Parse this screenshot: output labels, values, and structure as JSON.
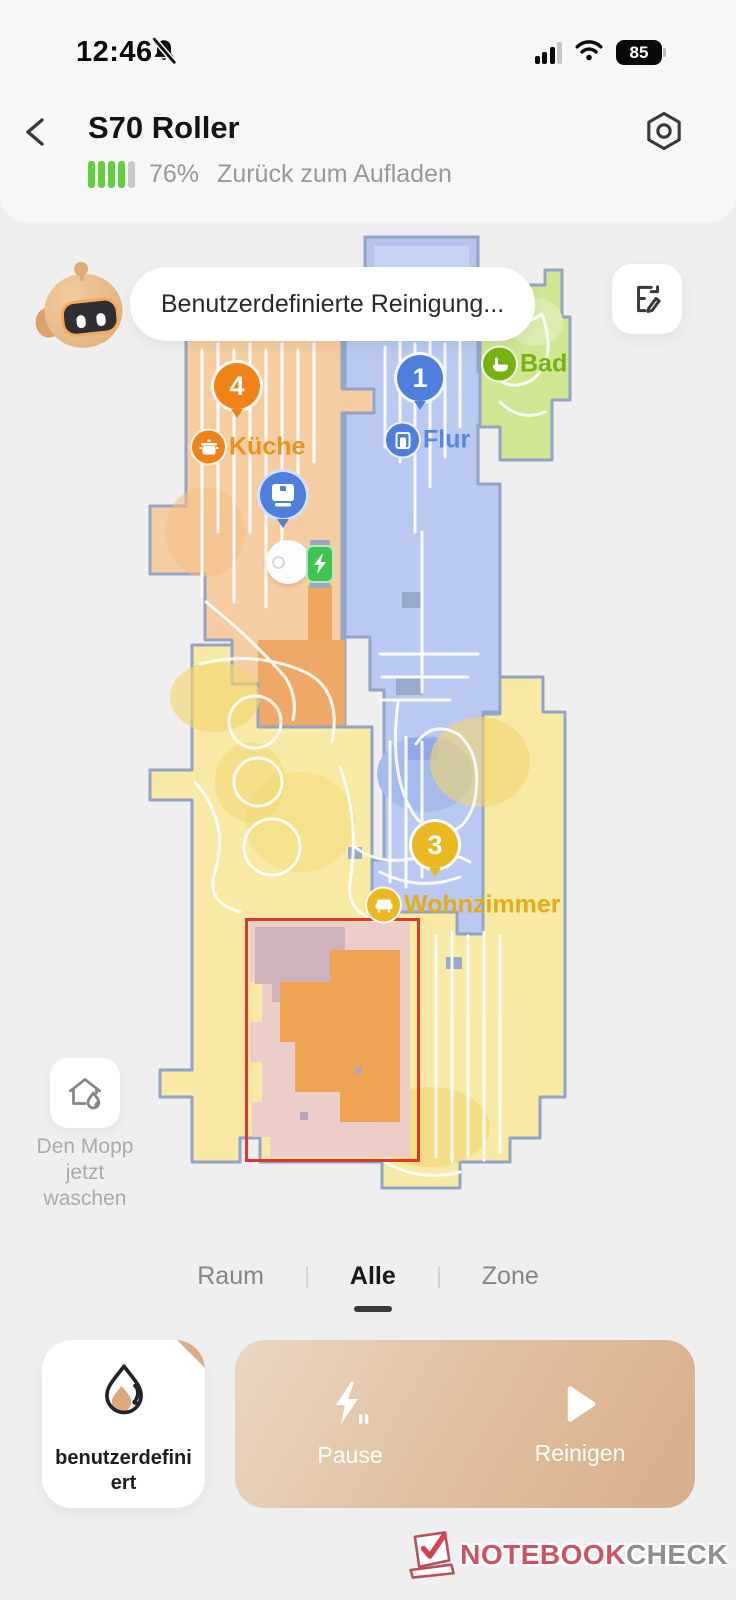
{
  "status_bar": {
    "time": "12:46",
    "battery_level": "85"
  },
  "header": {
    "title": "S70 Roller",
    "battery_percent": "76%",
    "status_text": "Zurück zum Aufladen",
    "battery_cells_full": 4,
    "battery_cells_total": 5
  },
  "assistant": {
    "message": "Benutzerdefinierte Reinigung..."
  },
  "map": {
    "rooms": [
      {
        "badge": "4",
        "name": "Küche",
        "color": "#ef8318",
        "fill": "#f6cda2",
        "icon": "pot-icon"
      },
      {
        "badge": "1",
        "name": "Flur",
        "color": "#4f7fdd",
        "fill": "#b9c9f1",
        "icon": "door-icon"
      },
      {
        "badge": "",
        "name": "Bad",
        "color": "#76b211",
        "fill": "#cfe693",
        "icon": "bath-icon"
      },
      {
        "badge": "3",
        "name": "Wohnzimmer",
        "color": "#e9b822",
        "fill": "#f8e9a4",
        "icon": "sofa-icon"
      }
    ],
    "zone_border_color": "#e5332d",
    "wall_color": "#93a4c6",
    "charger_color": "#3fc451"
  },
  "mop_button": {
    "line1": "Den Mopp",
    "line2": "jetzt",
    "line3": "waschen"
  },
  "tabs": [
    {
      "label": "Raum",
      "active": false
    },
    {
      "label": "Alle",
      "active": true
    },
    {
      "label": "Zone",
      "active": false
    }
  ],
  "controls": {
    "custom_label": "benutzerdefiniert",
    "pause_label": "Pause",
    "clean_label": "Reinigen",
    "panel_gradient": [
      "#ead7c3",
      "#d8ad8a"
    ]
  },
  "watermark": {
    "part1": "NOTEBOOK",
    "part2": "CHECK"
  }
}
